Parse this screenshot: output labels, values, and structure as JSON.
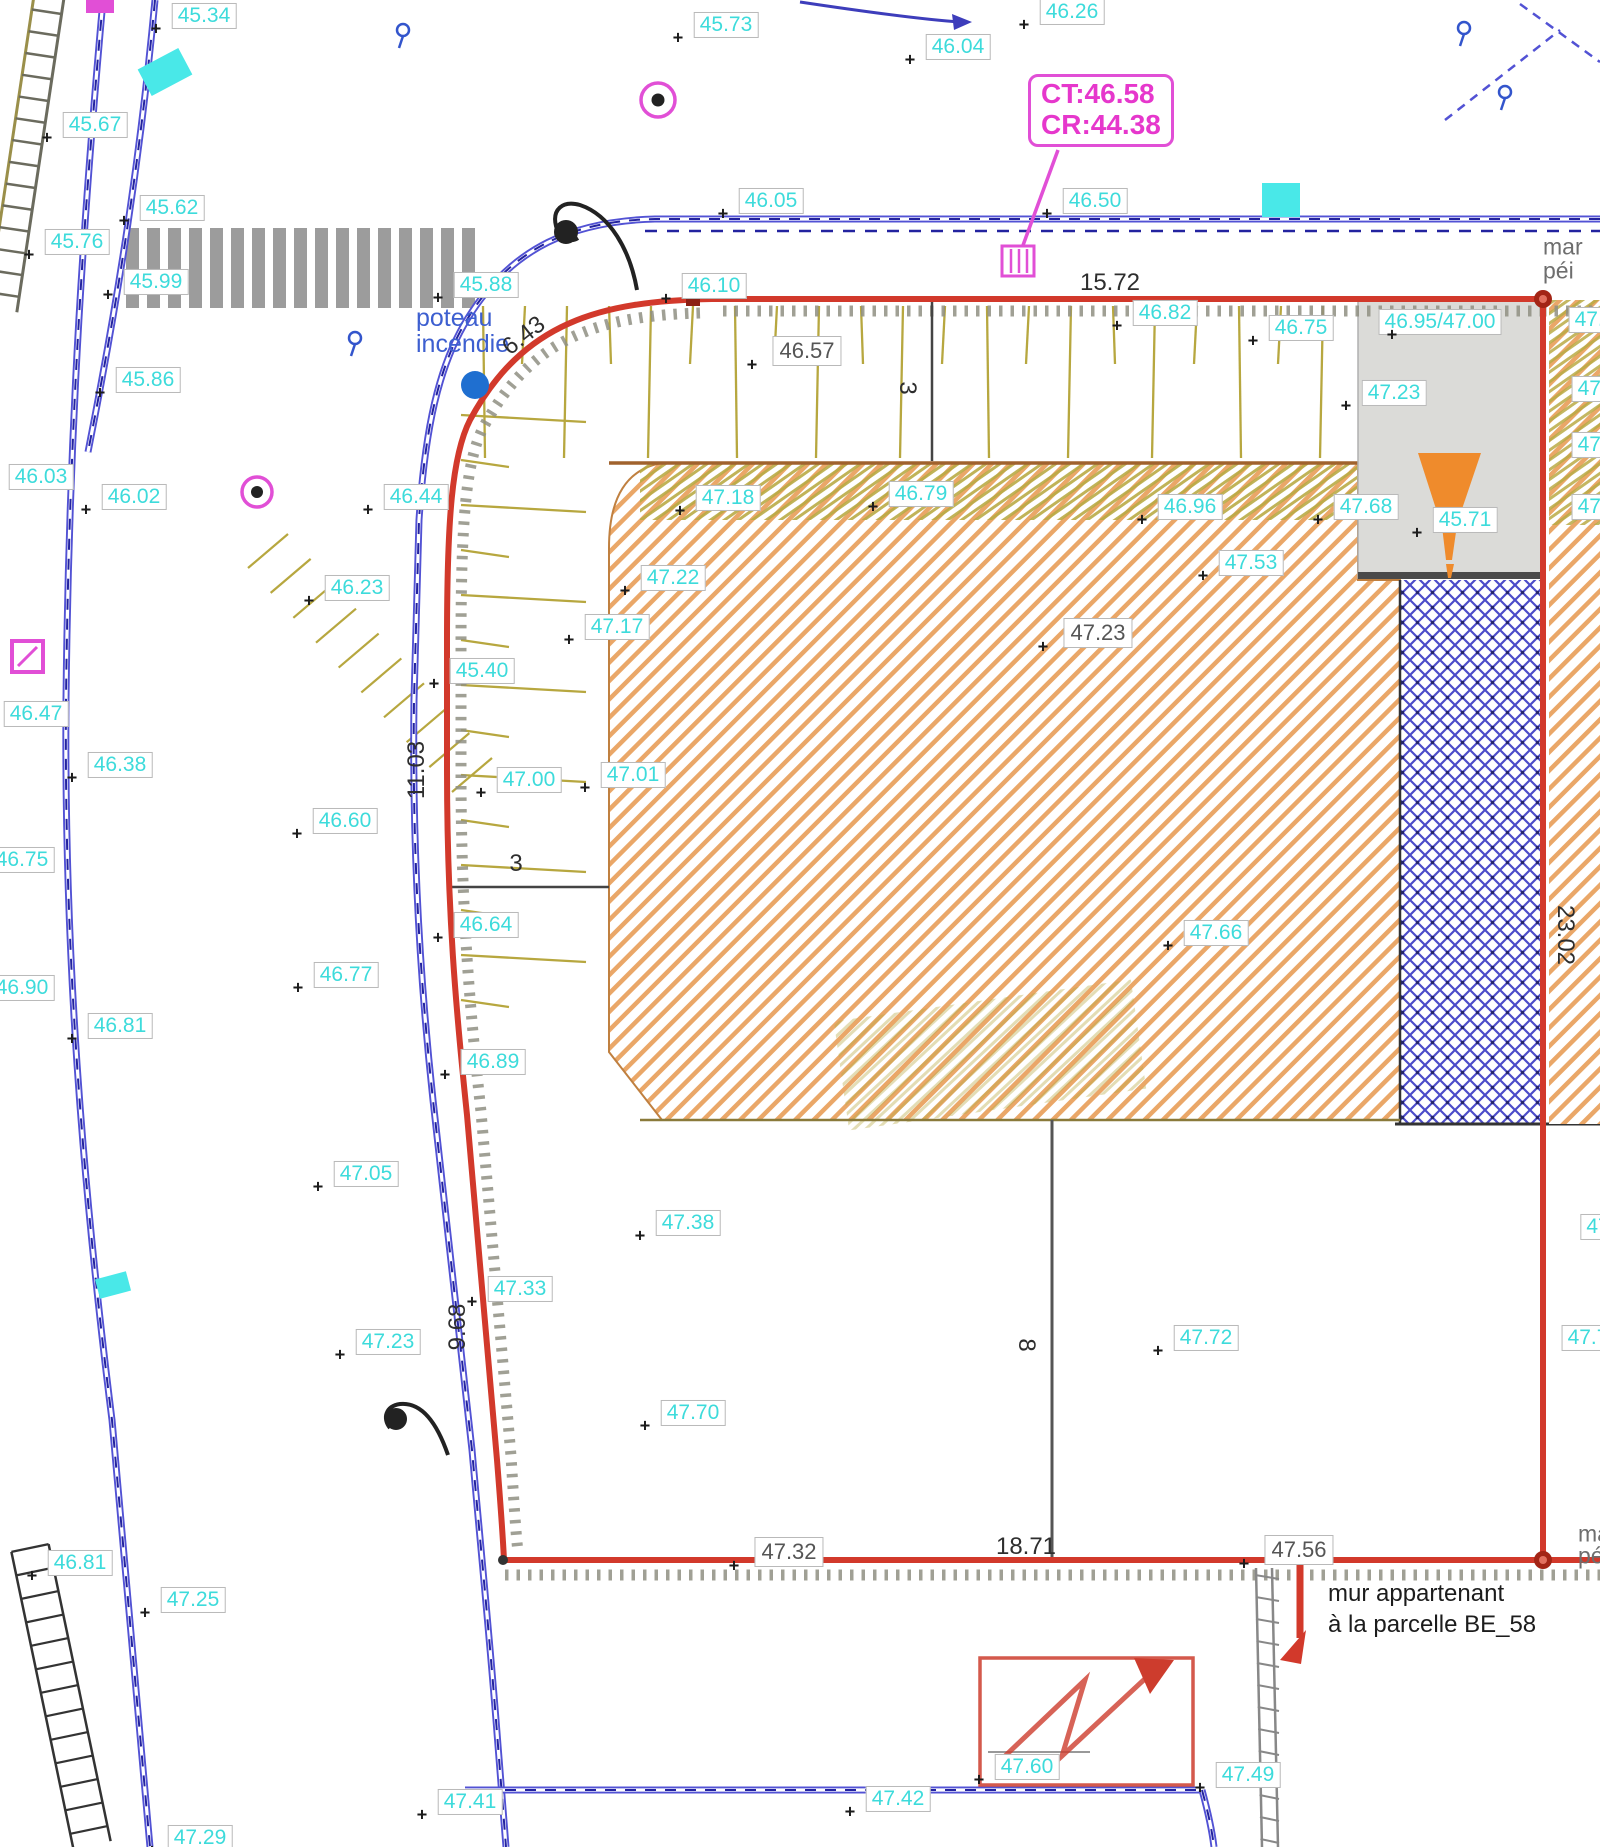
{
  "plan": {
    "type": "topographic-survey-plan",
    "callout": {
      "line1": "CT:46.58",
      "line2": "CR:44.38"
    },
    "notes": {
      "hydrant_line1": "poteau",
      "hydrant_line2": "incendie",
      "wall_line1": "mur appartenant",
      "wall_line2": "à la parcelle BE_58"
    },
    "edge_texts": [
      {
        "text": "mar",
        "x": 1543,
        "y": 247
      },
      {
        "text": "péi",
        "x": 1543,
        "y": 271
      },
      {
        "text": "ma",
        "x": 1578,
        "y": 1534
      },
      {
        "text": "pé",
        "x": 1578,
        "y": 1556
      }
    ],
    "spot_elevations": [
      {
        "x": 204,
        "y": 16,
        "v": "45.34"
      },
      {
        "x": 726,
        "y": 25,
        "v": "45.73"
      },
      {
        "x": 958,
        "y": 47,
        "v": "46.04"
      },
      {
        "x": 1072,
        "y": 12,
        "v": "46.26"
      },
      {
        "x": 95,
        "y": 125,
        "v": "45.67"
      },
      {
        "x": 172,
        "y": 208,
        "v": "45.62"
      },
      {
        "x": 77,
        "y": 242,
        "v": "45.76"
      },
      {
        "x": 156,
        "y": 282,
        "v": "45.99"
      },
      {
        "x": 486,
        "y": 285,
        "v": "45.88"
      },
      {
        "x": 771,
        "y": 201,
        "v": "46.05"
      },
      {
        "x": 714,
        "y": 286,
        "v": "46.10"
      },
      {
        "x": 1095,
        "y": 201,
        "v": "46.50"
      },
      {
        "x": 1165,
        "y": 313,
        "v": "46.82"
      },
      {
        "x": 1301,
        "y": 328,
        "v": "46.75"
      },
      {
        "x": 1440,
        "y": 322,
        "v": "46.95/47.00"
      },
      {
        "x": 1394,
        "y": 393,
        "v": "47.23"
      },
      {
        "x": 1366,
        "y": 507,
        "v": "47.68"
      },
      {
        "x": 1465,
        "y": 520,
        "v": "45.71"
      },
      {
        "x": 148,
        "y": 380,
        "v": "45.86"
      },
      {
        "x": 41,
        "y": 477,
        "v": "46.03"
      },
      {
        "x": 134,
        "y": 497,
        "v": "46.02"
      },
      {
        "x": 416,
        "y": 497,
        "v": "46.44"
      },
      {
        "x": 357,
        "y": 588,
        "v": "46.23"
      },
      {
        "x": 482,
        "y": 671,
        "v": "45.40"
      },
      {
        "x": 36,
        "y": 714,
        "v": "46.47"
      },
      {
        "x": 120,
        "y": 765,
        "v": "46.38"
      },
      {
        "x": 345,
        "y": 821,
        "v": "46.60"
      },
      {
        "x": 22,
        "y": 860,
        "v": "46.75"
      },
      {
        "x": 486,
        "y": 925,
        "v": "46.64"
      },
      {
        "x": 22,
        "y": 988,
        "v": "46.90"
      },
      {
        "x": 120,
        "y": 1026,
        "v": "46.81"
      },
      {
        "x": 346,
        "y": 975,
        "v": "46.77"
      },
      {
        "x": 493,
        "y": 1062,
        "v": "46.89"
      },
      {
        "x": 529,
        "y": 780,
        "v": "47.00"
      },
      {
        "x": 633,
        "y": 775,
        "v": "47.01"
      },
      {
        "x": 366,
        "y": 1174,
        "v": "47.05"
      },
      {
        "x": 673,
        "y": 578,
        "v": "47.22"
      },
      {
        "x": 617,
        "y": 627,
        "v": "47.17"
      },
      {
        "x": 728,
        "y": 498,
        "v": "47.18"
      },
      {
        "x": 921,
        "y": 494,
        "v": "46.79"
      },
      {
        "x": 1190,
        "y": 507,
        "v": "46.96"
      },
      {
        "x": 1251,
        "y": 563,
        "v": "47.53"
      },
      {
        "x": 1216,
        "y": 933,
        "v": "47.66"
      },
      {
        "x": 688,
        "y": 1223,
        "v": "47.38"
      },
      {
        "x": 520,
        "y": 1289,
        "v": "47.33"
      },
      {
        "x": 388,
        "y": 1342,
        "v": "47.23"
      },
      {
        "x": 1206,
        "y": 1338,
        "v": "47.72"
      },
      {
        "x": 693,
        "y": 1413,
        "v": "47.70"
      },
      {
        "x": 80,
        "y": 1563,
        "v": "46.81"
      },
      {
        "x": 193,
        "y": 1600,
        "v": "47.25"
      },
      {
        "x": 200,
        "y": 1838,
        "v": "47.29"
      },
      {
        "x": 470,
        "y": 1802,
        "v": "47.41"
      },
      {
        "x": 898,
        "y": 1799,
        "v": "47.42"
      },
      {
        "x": 1027,
        "y": 1767,
        "v": "47.60"
      },
      {
        "x": 1248,
        "y": 1775,
        "v": "47.49"
      },
      {
        "x": 1588,
        "y": 1338,
        "v": "47.7"
      },
      {
        "x": 1595,
        "y": 320,
        "v": "47.2"
      },
      {
        "x": 1598,
        "y": 389,
        "v": "47.1"
      },
      {
        "x": 1598,
        "y": 445,
        "v": "47.6"
      },
      {
        "x": 1598,
        "y": 507,
        "v": "47.5"
      },
      {
        "x": 1598,
        "y": 1227,
        "v": "47"
      }
    ],
    "dimensions": [
      {
        "x": 1110,
        "y": 283,
        "v": "15.72",
        "rot": 0
      },
      {
        "x": 524,
        "y": 336,
        "v": "6.43",
        "rot": -38
      },
      {
        "x": 907,
        "y": 388,
        "v": "3",
        "rot": 90
      },
      {
        "x": 516,
        "y": 864,
        "v": "3",
        "rot": 0
      },
      {
        "x": 417,
        "y": 770,
        "v": "11.03",
        "rot": -90
      },
      {
        "x": 458,
        "y": 1327,
        "v": "9.68",
        "rot": -90
      },
      {
        "x": 1026,
        "y": 1345,
        "v": "8",
        "rot": 90
      },
      {
        "x": 1565,
        "y": 935,
        "v": "23.02",
        "rot": 90
      },
      {
        "x": 1026,
        "y": 1547,
        "v": "18.71",
        "rot": 0
      }
    ],
    "boxed_dimensions": [
      {
        "x": 807,
        "y": 351,
        "v": "46.57"
      },
      {
        "x": 1098,
        "y": 633,
        "v": "47.23"
      },
      {
        "x": 789,
        "y": 1552,
        "v": "47.32"
      },
      {
        "x": 1299,
        "y": 1550,
        "v": "47.56"
      }
    ],
    "symbols": [
      {
        "name": "fire-hydrant-circle",
        "x": 475,
        "y": 385
      },
      {
        "name": "street-lamp",
        "x": 600,
        "y": 240
      },
      {
        "name": "street-lamp",
        "x": 415,
        "y": 1430
      },
      {
        "name": "survey-point-circled",
        "x": 658,
        "y": 100
      },
      {
        "name": "survey-point-circled",
        "x": 257,
        "y": 492
      },
      {
        "name": "drain-grate-magenta",
        "x": 1017,
        "y": 261
      },
      {
        "name": "utility-marker-magenta",
        "x": 27,
        "y": 657
      },
      {
        "name": "magenta-marker-top",
        "x": 100,
        "y": 6
      },
      {
        "name": "service-marker-cyan",
        "x": 165,
        "y": 72
      },
      {
        "name": "service-marker-cyan",
        "x": 1281,
        "y": 200
      },
      {
        "name": "service-marker-cyan",
        "x": 113,
        "y": 1285
      },
      {
        "name": "traffic-cone",
        "x": 1449,
        "y": 512
      },
      {
        "name": "slope-arrow-box",
        "x": 1086,
        "y": 1720
      },
      {
        "name": "wall-arrow-red",
        "x": 1300,
        "y": 1612
      }
    ],
    "colors": {
      "cyan_label": "#3ddbdb",
      "boundary_red": "#d2392b",
      "road_blue": "#5252d4",
      "dash_navy": "#23239f",
      "magenta": "#e14fd6",
      "hatch_orange": "#eaa768",
      "olive": "#b7a73f",
      "lattice_blue": "#4b4bc9",
      "gray_text": "#6e6e6e"
    }
  }
}
